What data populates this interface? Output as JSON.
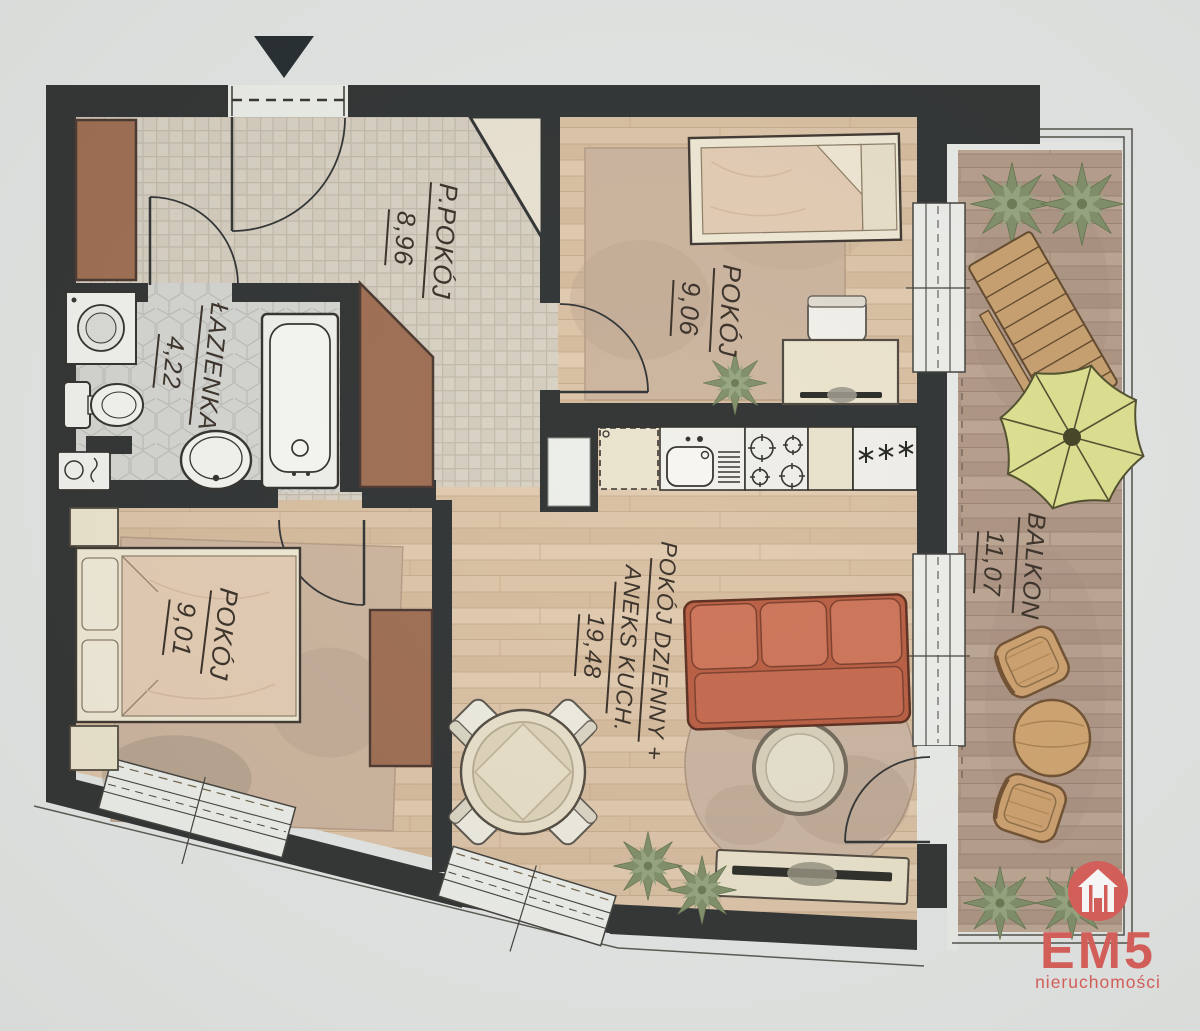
{
  "plan": {
    "rooms": [
      {
        "id": "hall",
        "name": "P.POKÓJ",
        "area": "8,96"
      },
      {
        "id": "bathroom",
        "name": "ŁAZIENKA",
        "area": "4,22"
      },
      {
        "id": "bedroom-small",
        "name": "POKÓJ",
        "area": "9,06"
      },
      {
        "id": "bedroom",
        "name": "POKÓJ",
        "area": "9,01"
      },
      {
        "id": "living",
        "name": "POKÓJ DZIENNY +",
        "name2": "ANEKS KUCH.",
        "area": "19,48"
      },
      {
        "id": "balcony",
        "name": "BALKON",
        "area": "11,07"
      }
    ],
    "kitchen": {
      "freezer_marking": "***"
    }
  },
  "icons": {
    "entrance": "entrance-arrow-icon",
    "freezer": "freezer-stars-icon",
    "logo": "em5-house-icon"
  },
  "branding": {
    "logo_text": "EM5",
    "logo_subtext": "nieruchomości",
    "brand_color": "#d95a55"
  },
  "colors": {
    "wall": "#2b2e2e",
    "wood_floor": "#dcc3a6",
    "balcony_deck": "#b29887",
    "sofa": "#c96e51",
    "umbrella": "#dee08e"
  }
}
